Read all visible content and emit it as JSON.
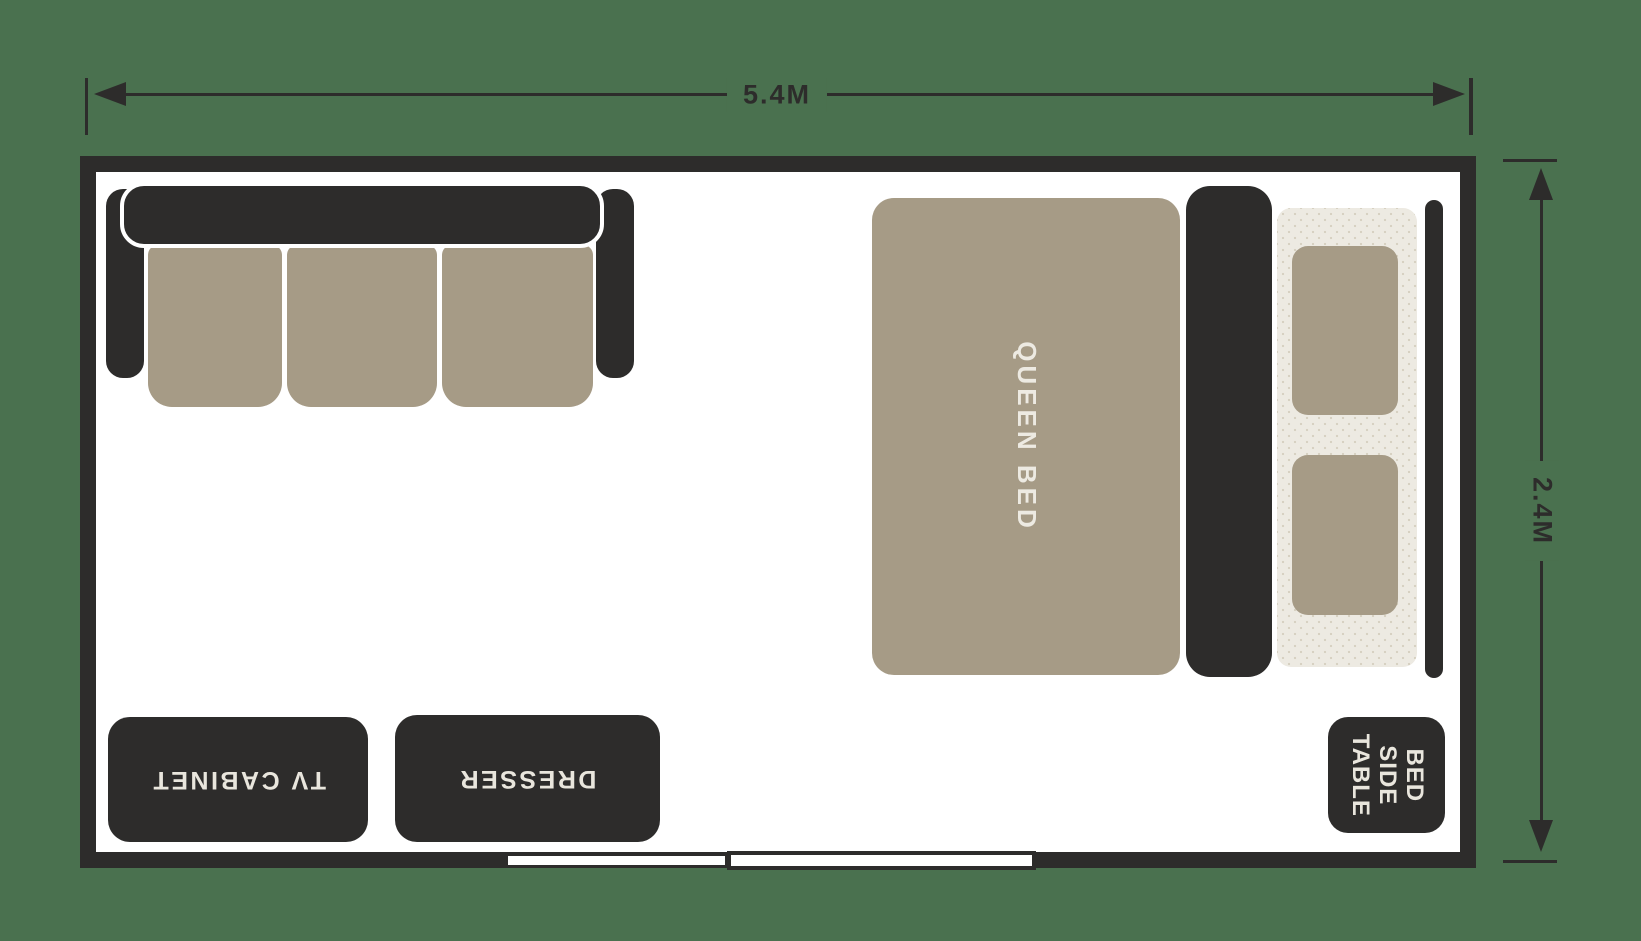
{
  "floorplan": {
    "title": "bedroom floor plan",
    "dimensions": {
      "width": {
        "label": "5.4M"
      },
      "height": {
        "label": "2.4M"
      }
    },
    "furniture": {
      "sofa": {
        "name": "three seat sofa",
        "cushions": 3
      },
      "queen_bed": {
        "label": "QUEEN BED",
        "pillows": 2
      },
      "tv_cabinet": {
        "label": "TV CABINET"
      },
      "dresser": {
        "label": "DRESSER"
      },
      "bedside_table": {
        "lines": [
          "BED",
          "SIDE",
          "TABLE"
        ]
      }
    },
    "colors": {
      "background_green": "#4a714f",
      "wall_dark": "#2d2c2b",
      "upholstery_taupe": "#a69b86",
      "linen_cream": "#edeae2",
      "floor_white": "#ffffff",
      "label_light": "#e9e6dd"
    }
  }
}
